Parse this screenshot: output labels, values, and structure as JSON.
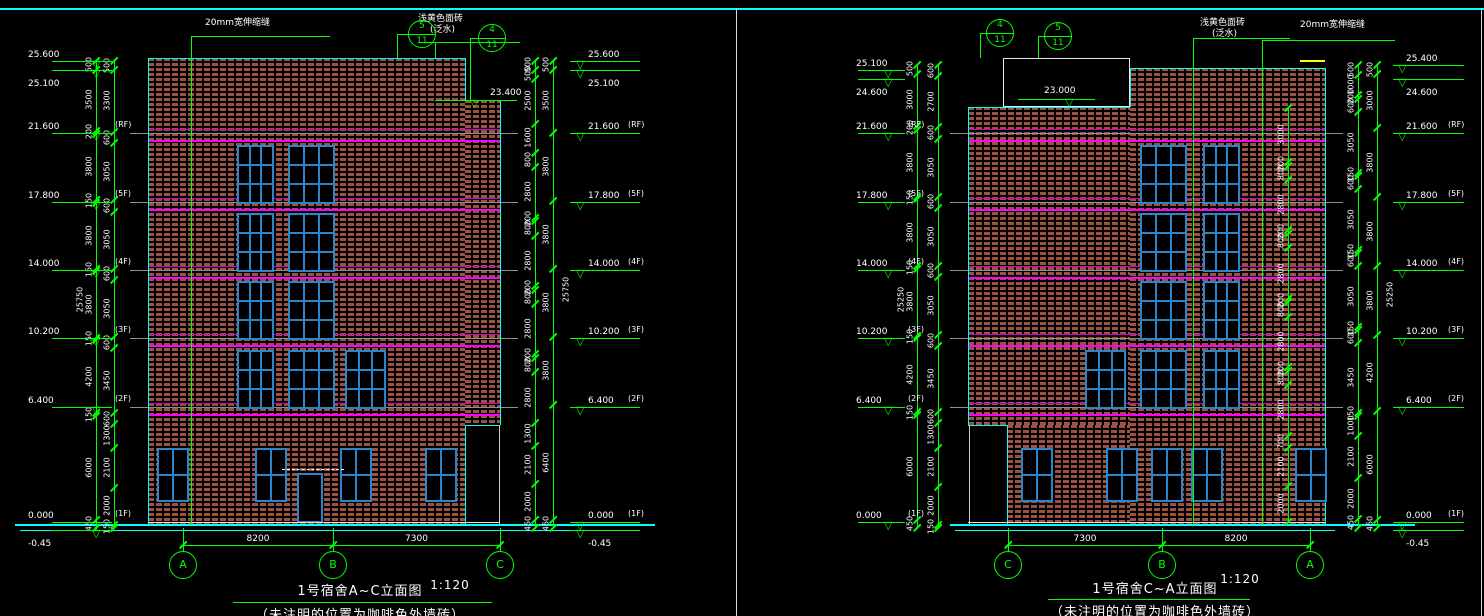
{
  "colors": {
    "background": "#000000",
    "green": "#00ff00",
    "cyan": "#00ffff",
    "magenta_strong": "#ff00ff",
    "magenta_thin": "#cc00cc",
    "gray": "#909090",
    "brick": "#9c5243",
    "window_frame": "#2a86c8",
    "white": "#ffffff",
    "yellow": "#ffff00"
  },
  "drawings": [
    {
      "id": "left",
      "title": "1号宿舍A~C立面图",
      "scale": "1:120",
      "subtitle": "（未注明的位置为咖啡色外墙砖）",
      "grid_bubbles": [
        "A",
        "B",
        "C"
      ],
      "bay_dims": [
        "8200",
        "7300"
      ],
      "detail_bubbles": [
        {
          "number": "5",
          "sheet": "11"
        },
        {
          "number": "4",
          "sheet": "11"
        }
      ],
      "annotations": [
        {
          "line1": "20mm宽伸缩缝",
          "line2": ""
        },
        {
          "line1": "浅黄色面砖",
          "line2": "(泛水)"
        }
      ],
      "step_marker": "23.400",
      "markers_left": [
        {
          "value": "25.600"
        },
        {
          "value": "25.100",
          "inverted": true
        },
        {
          "value": "21.600",
          "floor": "(RF)"
        },
        {
          "value": "17.800",
          "floor": "(5F)"
        },
        {
          "value": "14.000",
          "floor": "(4F)"
        },
        {
          "value": "10.200",
          "floor": "(3F)"
        },
        {
          "value": "6.400",
          "floor": "(2F)"
        },
        {
          "value": "0.000",
          "floor": "(1F)"
        },
        {
          "value": "-0.45",
          "inverted": true
        }
      ],
      "markers_right": [
        {
          "value": "25.600"
        },
        {
          "value": "25.100",
          "inverted": true
        },
        {
          "value": "21.600",
          "floor": "(RF)"
        },
        {
          "value": "17.800",
          "floor": "(5F)"
        },
        {
          "value": "14.000",
          "floor": "(4F)"
        },
        {
          "value": "10.200",
          "floor": "(3F)"
        },
        {
          "value": "6.400",
          "floor": "(2F)"
        },
        {
          "value": "0.000",
          "floor": "(1F)"
        },
        {
          "value": "-0.45",
          "inverted": true
        }
      ],
      "left_chain_inner": [
        "500",
        "3500",
        "200",
        "3800",
        "150",
        "3800",
        "150",
        "3800",
        "150",
        "4200",
        "150",
        "6000",
        "450"
      ],
      "left_chain_outer": [
        "500",
        "3300",
        "600",
        "3050",
        "600",
        "3050",
        "600",
        "3050",
        "600",
        "3450",
        "600",
        "1300",
        "2100",
        "2000",
        "150"
      ],
      "right_chain_inner": [
        "500",
        "500",
        "2500",
        "1600",
        "800",
        "2800",
        "200",
        "800",
        "2800",
        "200",
        "800",
        "2800",
        "200",
        "800",
        "2800",
        "1300",
        "2100",
        "2000",
        "450"
      ],
      "right_chain_outer": [
        "500",
        "3500",
        "3800",
        "3800",
        "3800",
        "3800",
        "6400",
        "450"
      ],
      "totals": {
        "left": "25750",
        "right": "25750"
      }
    },
    {
      "id": "right",
      "title": "1号宿舍C~A立面图",
      "scale": "1:120",
      "subtitle": "（未注明的位置为咖啡色外墙砖）",
      "grid_bubbles": [
        "C",
        "B",
        "A"
      ],
      "bay_dims": [
        "7300",
        "8200"
      ],
      "detail_bubbles": [
        {
          "number": "4",
          "sheet": "11"
        },
        {
          "number": "5",
          "sheet": "11"
        }
      ],
      "annotations": [
        {
          "line1": "浅黄色面砖",
          "line2": "(泛水)"
        },
        {
          "line1": "20mm宽伸缩缝",
          "line2": ""
        }
      ],
      "step_marker": "23.000",
      "markers_left": [
        {
          "value": "25.100"
        },
        {
          "value": "24.600",
          "inverted": true
        },
        {
          "value": "21.600",
          "floor": "(RF)"
        },
        {
          "value": "17.800",
          "floor": "(5F)"
        },
        {
          "value": "14.000",
          "floor": "(4F)"
        },
        {
          "value": "10.200",
          "floor": "(3F)"
        },
        {
          "value": "6.400",
          "floor": "(2F)"
        },
        {
          "value": "0.000",
          "floor": "(1F)"
        }
      ],
      "markers_right": [
        {
          "value": "25.400"
        },
        {
          "value": "24.600",
          "inverted": true
        },
        {
          "value": "21.600",
          "floor": "(RF)"
        },
        {
          "value": "17.800",
          "floor": "(5F)"
        },
        {
          "value": "14.000",
          "floor": "(4F)"
        },
        {
          "value": "10.200",
          "floor": "(3F)"
        },
        {
          "value": "6.400",
          "floor": "(2F)"
        },
        {
          "value": "0.000",
          "floor": "(1F)"
        },
        {
          "value": "-0.45",
          "inverted": true
        }
      ],
      "left_chain_inner": [
        "500",
        "3000",
        "200",
        "3800",
        "150",
        "3800",
        "150",
        "3800",
        "150",
        "4200",
        "150",
        "6000",
        "450"
      ],
      "left_chain_outer": [
        "600",
        "2700",
        "600",
        "3050",
        "600",
        "3050",
        "600",
        "3050",
        "600",
        "3450",
        "600",
        "1300",
        "2100",
        "2000",
        "150"
      ],
      "right_chain_inner": [
        "500",
        "1000",
        "200",
        "600",
        "3050",
        "150",
        "600",
        "3050",
        "150",
        "600",
        "3050",
        "150",
        "600",
        "3450",
        "150",
        "1000",
        "2100",
        "2000",
        "450"
      ],
      "right_chain_outer": [
        "500",
        "3000",
        "3800",
        "3800",
        "3800",
        "4200",
        "6000",
        "450"
      ],
      "facade_chain": [
        "3000",
        "200",
        "800",
        "2800",
        "200",
        "800",
        "2800",
        "200",
        "800",
        "2800",
        "200",
        "800",
        "2800",
        "700",
        "2100",
        "2000"
      ],
      "totals": {
        "left": "25250",
        "right": "25250"
      }
    }
  ]
}
